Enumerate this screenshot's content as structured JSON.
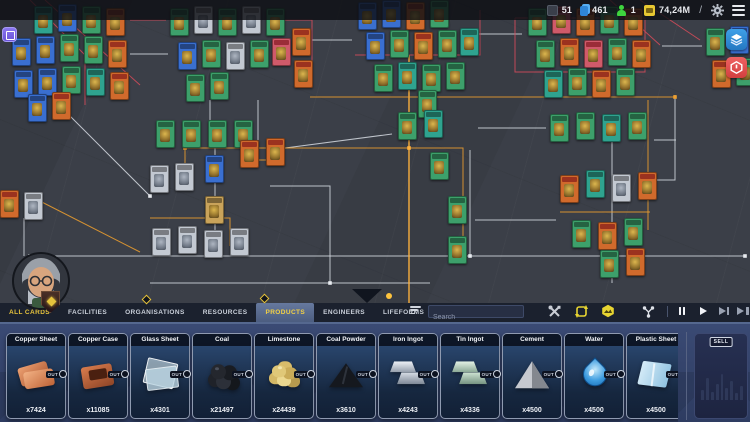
{
  "top_bar": {
    "stats": [
      {
        "icon": "deck-icon",
        "value": "51"
      },
      {
        "icon": "cards-icon",
        "value": "461"
      },
      {
        "icon": "lifeform-icon",
        "value": "1"
      },
      {
        "icon": "money-icon",
        "value": "74,24M"
      }
    ],
    "slash": "/"
  },
  "side_buttons": {
    "layers": "layers-icon",
    "power": "power-hex-icon"
  },
  "photo_button": "photo-mode-icon",
  "tabs": {
    "items": [
      "ALL CARDS",
      "FACILITIES",
      "ORGANISATIONS",
      "RESOURCES",
      "PRODUCTS",
      "ENGINEERS",
      "LIFEFORMS"
    ],
    "active": "PRODUCTS",
    "active_index": 4
  },
  "search": {
    "placeholder": "Search"
  },
  "toolbar_icons": [
    "repair-tools-icon",
    "recycle-icon",
    "polymer-icon",
    "network-icon"
  ],
  "playback": [
    "pause",
    "play",
    "fast-forward",
    "skip-to-end"
  ],
  "tray": {
    "out_label": "OUT",
    "cards": [
      {
        "title": "Copper Sheet",
        "count": "x7424",
        "art": "copper-sheet"
      },
      {
        "title": "Copper Case",
        "count": "x11085",
        "art": "copper-case"
      },
      {
        "title": "Glass Sheet",
        "count": "x4301",
        "art": "glass-sheet"
      },
      {
        "title": "Coal",
        "count": "x21497",
        "art": "coal"
      },
      {
        "title": "Limestone",
        "count": "x24439",
        "art": "limestone"
      },
      {
        "title": "Coal Powder",
        "count": "x3610",
        "art": "coal-powder"
      },
      {
        "title": "Iron Ingot",
        "count": "x4243",
        "art": "iron-ingot"
      },
      {
        "title": "Tin Ingot",
        "count": "x4336",
        "art": "tin-ingot"
      },
      {
        "title": "Cement",
        "count": "x4500",
        "art": "cement"
      },
      {
        "title": "Water",
        "count": "x4500",
        "art": "water"
      },
      {
        "title": "Plastic Sheet",
        "count": "x4500",
        "art": "plastic-sheet"
      }
    ],
    "sell": {
      "label": "SELL",
      "bars": [
        10,
        22,
        8,
        16,
        26,
        12,
        19,
        7,
        14
      ]
    }
  },
  "board": {
    "cards": [
      {
        "x": 34,
        "y": 6,
        "c": "t"
      },
      {
        "x": 58,
        "y": 4,
        "c": "b"
      },
      {
        "x": 82,
        "y": 6,
        "c": "g"
      },
      {
        "x": 106,
        "y": 8,
        "c": "o"
      },
      {
        "x": 12,
        "y": 38,
        "c": "b"
      },
      {
        "x": 36,
        "y": 36,
        "c": "b"
      },
      {
        "x": 60,
        "y": 34,
        "c": "g"
      },
      {
        "x": 84,
        "y": 36,
        "c": "g"
      },
      {
        "x": 108,
        "y": 40,
        "c": "o"
      },
      {
        "x": 14,
        "y": 70,
        "c": "b"
      },
      {
        "x": 38,
        "y": 68,
        "c": "b"
      },
      {
        "x": 62,
        "y": 66,
        "c": "g"
      },
      {
        "x": 86,
        "y": 68,
        "c": "t"
      },
      {
        "x": 110,
        "y": 72,
        "c": "o"
      },
      {
        "x": 28,
        "y": 94,
        "c": "b"
      },
      {
        "x": 52,
        "y": 92,
        "c": "o"
      },
      {
        "x": 170,
        "y": 8,
        "c": "g"
      },
      {
        "x": 194,
        "y": 6,
        "c": "w"
      },
      {
        "x": 218,
        "y": 8,
        "c": "g"
      },
      {
        "x": 242,
        "y": 6,
        "c": "w"
      },
      {
        "x": 266,
        "y": 8,
        "c": "g"
      },
      {
        "x": 178,
        "y": 42,
        "c": "b"
      },
      {
        "x": 202,
        "y": 40,
        "c": "g"
      },
      {
        "x": 226,
        "y": 42,
        "c": "w"
      },
      {
        "x": 250,
        "y": 40,
        "c": "g"
      },
      {
        "x": 272,
        "y": 38,
        "c": "p"
      },
      {
        "x": 186,
        "y": 74,
        "c": "g"
      },
      {
        "x": 210,
        "y": 72,
        "c": "g"
      },
      {
        "x": 292,
        "y": 28,
        "c": "o"
      },
      {
        "x": 294,
        "y": 60,
        "c": "o"
      },
      {
        "x": 358,
        "y": 2,
        "c": "b"
      },
      {
        "x": 382,
        "y": 0,
        "c": "b"
      },
      {
        "x": 406,
        "y": 2,
        "c": "o"
      },
      {
        "x": 430,
        "y": 0,
        "c": "g"
      },
      {
        "x": 366,
        "y": 32,
        "c": "b"
      },
      {
        "x": 390,
        "y": 30,
        "c": "g"
      },
      {
        "x": 414,
        "y": 32,
        "c": "o"
      },
      {
        "x": 438,
        "y": 30,
        "c": "g"
      },
      {
        "x": 460,
        "y": 28,
        "c": "t"
      },
      {
        "x": 374,
        "y": 64,
        "c": "g"
      },
      {
        "x": 398,
        "y": 62,
        "c": "t"
      },
      {
        "x": 422,
        "y": 64,
        "c": "g"
      },
      {
        "x": 446,
        "y": 62,
        "c": "g"
      },
      {
        "x": 418,
        "y": 90,
        "c": "g"
      },
      {
        "x": 528,
        "y": 8,
        "c": "g"
      },
      {
        "x": 552,
        "y": 6,
        "c": "p"
      },
      {
        "x": 576,
        "y": 8,
        "c": "o"
      },
      {
        "x": 600,
        "y": 6,
        "c": "g"
      },
      {
        "x": 624,
        "y": 8,
        "c": "o"
      },
      {
        "x": 536,
        "y": 40,
        "c": "g"
      },
      {
        "x": 560,
        "y": 38,
        "c": "o"
      },
      {
        "x": 584,
        "y": 40,
        "c": "p"
      },
      {
        "x": 608,
        "y": 38,
        "c": "g"
      },
      {
        "x": 632,
        "y": 40,
        "c": "o"
      },
      {
        "x": 544,
        "y": 70,
        "c": "t"
      },
      {
        "x": 568,
        "y": 68,
        "c": "g"
      },
      {
        "x": 592,
        "y": 70,
        "c": "o"
      },
      {
        "x": 616,
        "y": 68,
        "c": "g"
      },
      {
        "x": 706,
        "y": 28,
        "c": "g"
      },
      {
        "x": 730,
        "y": 26,
        "c": "b"
      },
      {
        "x": 712,
        "y": 60,
        "c": "o"
      },
      {
        "x": 736,
        "y": 58,
        "c": "g"
      },
      {
        "x": 156,
        "y": 120,
        "c": "g"
      },
      {
        "x": 182,
        "y": 120,
        "c": "g"
      },
      {
        "x": 208,
        "y": 120,
        "c": "g"
      },
      {
        "x": 234,
        "y": 120,
        "c": "g"
      },
      {
        "x": 150,
        "y": 165,
        "c": "w"
      },
      {
        "x": 175,
        "y": 163,
        "c": "w"
      },
      {
        "x": 205,
        "y": 155,
        "c": "b"
      },
      {
        "x": 240,
        "y": 140,
        "c": "o"
      },
      {
        "x": 266,
        "y": 138,
        "c": "o"
      },
      {
        "x": 205,
        "y": 196,
        "c": "y"
      },
      {
        "x": 152,
        "y": 228,
        "c": "w"
      },
      {
        "x": 178,
        "y": 226,
        "c": "w"
      },
      {
        "x": 204,
        "y": 230,
        "c": "w"
      },
      {
        "x": 230,
        "y": 228,
        "c": "w"
      },
      {
        "x": 398,
        "y": 112,
        "c": "g"
      },
      {
        "x": 424,
        "y": 110,
        "c": "t"
      },
      {
        "x": 430,
        "y": 152,
        "c": "g"
      },
      {
        "x": 448,
        "y": 196,
        "c": "g"
      },
      {
        "x": 448,
        "y": 236,
        "c": "g"
      },
      {
        "x": 550,
        "y": 114,
        "c": "g"
      },
      {
        "x": 576,
        "y": 112,
        "c": "g"
      },
      {
        "x": 602,
        "y": 114,
        "c": "t"
      },
      {
        "x": 628,
        "y": 112,
        "c": "g"
      },
      {
        "x": 560,
        "y": 175,
        "c": "o"
      },
      {
        "x": 586,
        "y": 170,
        "c": "t"
      },
      {
        "x": 612,
        "y": 174,
        "c": "w"
      },
      {
        "x": 638,
        "y": 172,
        "c": "o"
      },
      {
        "x": 572,
        "y": 220,
        "c": "g"
      },
      {
        "x": 598,
        "y": 222,
        "c": "o"
      },
      {
        "x": 624,
        "y": 218,
        "c": "g"
      },
      {
        "x": 0,
        "y": 190,
        "c": "o"
      },
      {
        "x": 24,
        "y": 192,
        "c": "w"
      },
      {
        "x": 600,
        "y": 250,
        "c": "g"
      },
      {
        "x": 626,
        "y": 248,
        "c": "o"
      }
    ],
    "wires": [
      {
        "c": "#d6dae2",
        "p": "30,256 745,256"
      },
      {
        "c": "#d6dae2",
        "p": "150,283 430,283"
      },
      {
        "c": "#d6dae2",
        "p": "215,146 215,256"
      },
      {
        "c": "#d6dae2",
        "p": "270,186 330,186 330,283"
      },
      {
        "c": "#d6dae2",
        "p": "470,150 470,256"
      },
      {
        "c": "#d6dae2",
        "p": "612,120 612,283"
      },
      {
        "c": "#d6dae2",
        "p": "675,95 675,180 640,180"
      },
      {
        "c": "#d6dae2",
        "p": "130,54 168,54"
      },
      {
        "c": "#d6dae2",
        "p": "312,40 352,40"
      },
      {
        "c": "#d6dae2",
        "p": "478,34 522,34"
      },
      {
        "c": "#d6dae2",
        "p": "662,46 702,46"
      },
      {
        "c": "#d6dae2",
        "p": "60,106 150,196"
      },
      {
        "c": "#d6dae2",
        "p": "270,150 392,134"
      },
      {
        "c": "#d6dae2",
        "p": "478,128 546,128"
      },
      {
        "c": "#d6dae2",
        "p": "654,140 676,140"
      },
      {
        "c": "#d6dae2",
        "p": "210,100 210,122"
      },
      {
        "c": "#d6dae2",
        "p": "258,100 258,140"
      },
      {
        "c": "#d6dae2",
        "p": "475,220 556,220"
      },
      {
        "c": "#d6dae2",
        "p": "24,218 24,256"
      },
      {
        "c": "#ffb13d",
        "p": "409,55 409,303"
      },
      {
        "c": "#f0a02e",
        "p": "185,166 185,148 409,148"
      },
      {
        "c": "#f0a02e",
        "p": "409,148 463,148 463,240"
      },
      {
        "c": "#f0a02e",
        "p": "310,97 675,97"
      },
      {
        "c": "#f0a02e",
        "p": "240,160 266,160"
      },
      {
        "c": "#f0a02e",
        "p": "150,218 230,218 230,246"
      },
      {
        "c": "#f0a02e",
        "p": "30,196 140,252"
      },
      {
        "c": "#f0a02e",
        "p": "560,212 650,212"
      },
      {
        "c": "#f0a02e",
        "p": "648,100 648,230"
      },
      {
        "c": "#d84b5a",
        "p": "30,0 85,55 85,105"
      },
      {
        "c": "#d84b5a",
        "p": "45,0 140,85"
      },
      {
        "c": "#d84b5a",
        "p": "515,18 645,18 645,72 515,72 515,18"
      },
      {
        "c": "#d84b5a",
        "p": "610,0 660,45"
      },
      {
        "c": "#d84b5a",
        "p": "640,0 700,40"
      },
      {
        "c": "#d84b5a",
        "p": "355,55 480,55 480,10"
      },
      {
        "c": "#d84b5a",
        "p": "285,20 312,20 312,75"
      },
      {
        "c": "#d84b5a",
        "p": "130,20 166,20"
      }
    ],
    "nodes": [
      {
        "x": 215,
        "y": 256,
        "c": "#e8ebf0"
      },
      {
        "x": 330,
        "y": 283,
        "c": "#e8ebf0"
      },
      {
        "x": 470,
        "y": 256,
        "c": "#e8ebf0"
      },
      {
        "x": 612,
        "y": 256,
        "c": "#e8ebf0"
      },
      {
        "x": 185,
        "y": 148,
        "c": "#ffb13d"
      },
      {
        "x": 409,
        "y": 148,
        "c": "#ffb13d"
      },
      {
        "x": 463,
        "y": 240,
        "c": "#ffb13d"
      },
      {
        "x": 675,
        "y": 97,
        "c": "#f0a02e"
      },
      {
        "x": 612,
        "y": 120,
        "c": "#e8ebf0"
      },
      {
        "x": 150,
        "y": 196,
        "c": "#e8ebf0"
      },
      {
        "x": 745,
        "y": 256,
        "c": "#e8ebf0"
      },
      {
        "x": 30,
        "y": 256,
        "c": "#e8ebf0"
      }
    ]
  }
}
